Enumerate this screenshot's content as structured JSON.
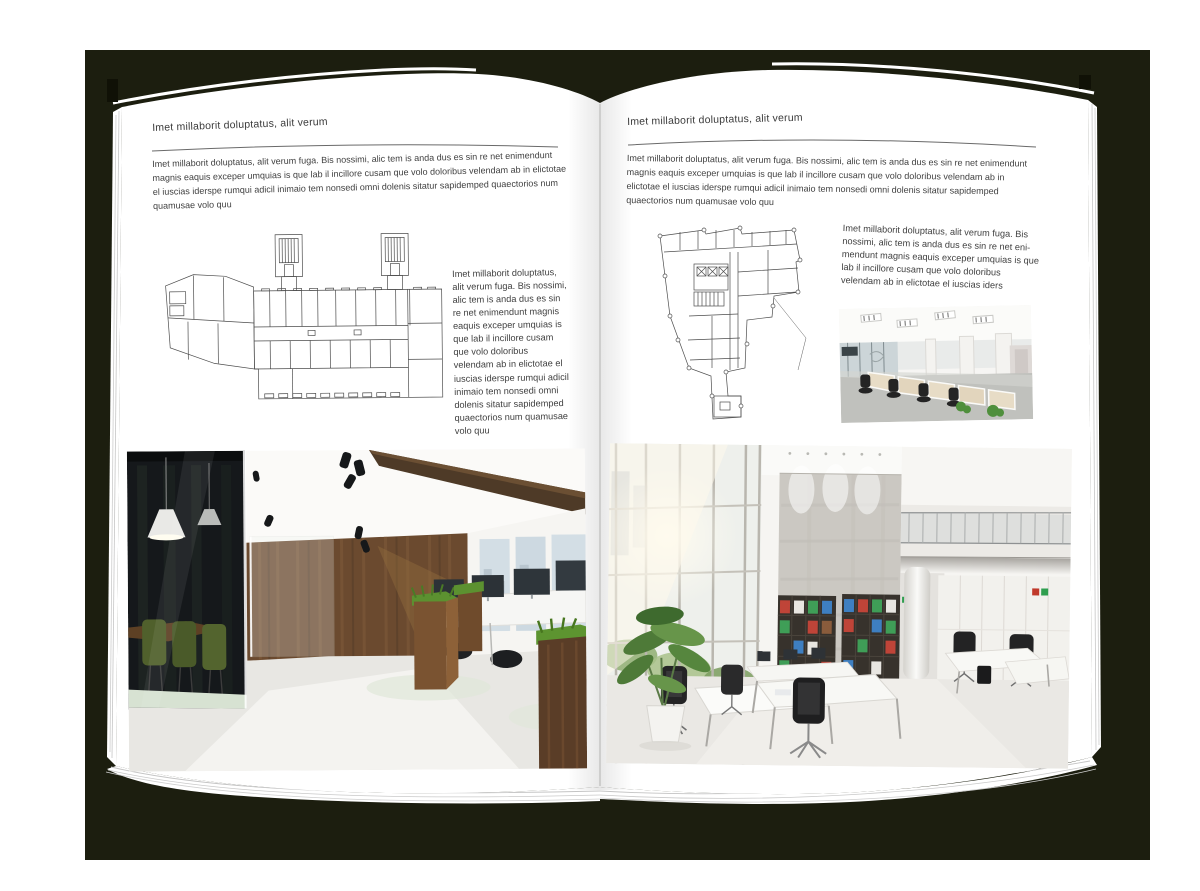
{
  "scene": {
    "backdrop_color": "#1c1e0f",
    "canvas_color": "#ffffff",
    "page_color": "#ffffff"
  },
  "palette": {
    "plan_line": "#4d4d4d",
    "wood_brown": "#6b4a2f",
    "grass_green": "#5c9130",
    "chair_olive": "#50602c",
    "binder_red": "#bf4438",
    "binder_green": "#3f9e57",
    "binder_blue": "#3e7fc1"
  },
  "left_page": {
    "header": "Imet millaborit doluptatus, alit verum",
    "intro": "Imet millaborit doluptatus, alit verum fuga. Bis nossimi, alic tem is anda dus es sin re net enimendunt magnis eaquis exceper umquias is que lab il incillore cusam que volo doloribus velendam ab in elictotae el iuscias iderspe rumqui adicil inimaio tem nonsedi omni dolenis sitatur sapidemped quaectorios num quamusae volo quu",
    "caption": "Imet millaborit doluptatus, alit verum fuga. Bis nossimi, alic tem is anda dus es sin re net enimendunt magnis eaquis exceper umquias is que lab il incillore cusam que volo doloribus velendam ab in elictotae el iuscias iderspe rumqui adicil inimaio tem nonsedi omni dolenis sitatur sapidemped quaectorios num quamusae volo quu",
    "floor_plan": "wide-building-level-plan",
    "photo": "office-interior-dark-wood-photo"
  },
  "right_page": {
    "header": "Imet millaborit doluptatus, alit verum",
    "intro": "Imet millaborit doluptatus, alit verum fuga. Bis nossimi, alic tem is anda dus es sin re net enimendunt magnis eaquis exceper umquias is que lab il incillore cusam que volo doloribus velendam ab in elictotae el iuscias iderspe rumqui adicil inimaio tem nonsedi omni dolenis sitatur sapidemped quaectorios num quamusae volo quu",
    "caption": "Imet millaborit doluptatus, alit verum fuga. Bis nossimi, alic tem is anda dus es sin re net eni-mendunt magnis eaquis exceper umquias is que lab il incillore cusam que volo doloribus velendam ab in elictotae el iuscias iders",
    "floor_plan": "irregular-tower-level-plan",
    "photo_small": "open-office-workstations-photo",
    "photo": "office-interior-white-loft-photo"
  }
}
